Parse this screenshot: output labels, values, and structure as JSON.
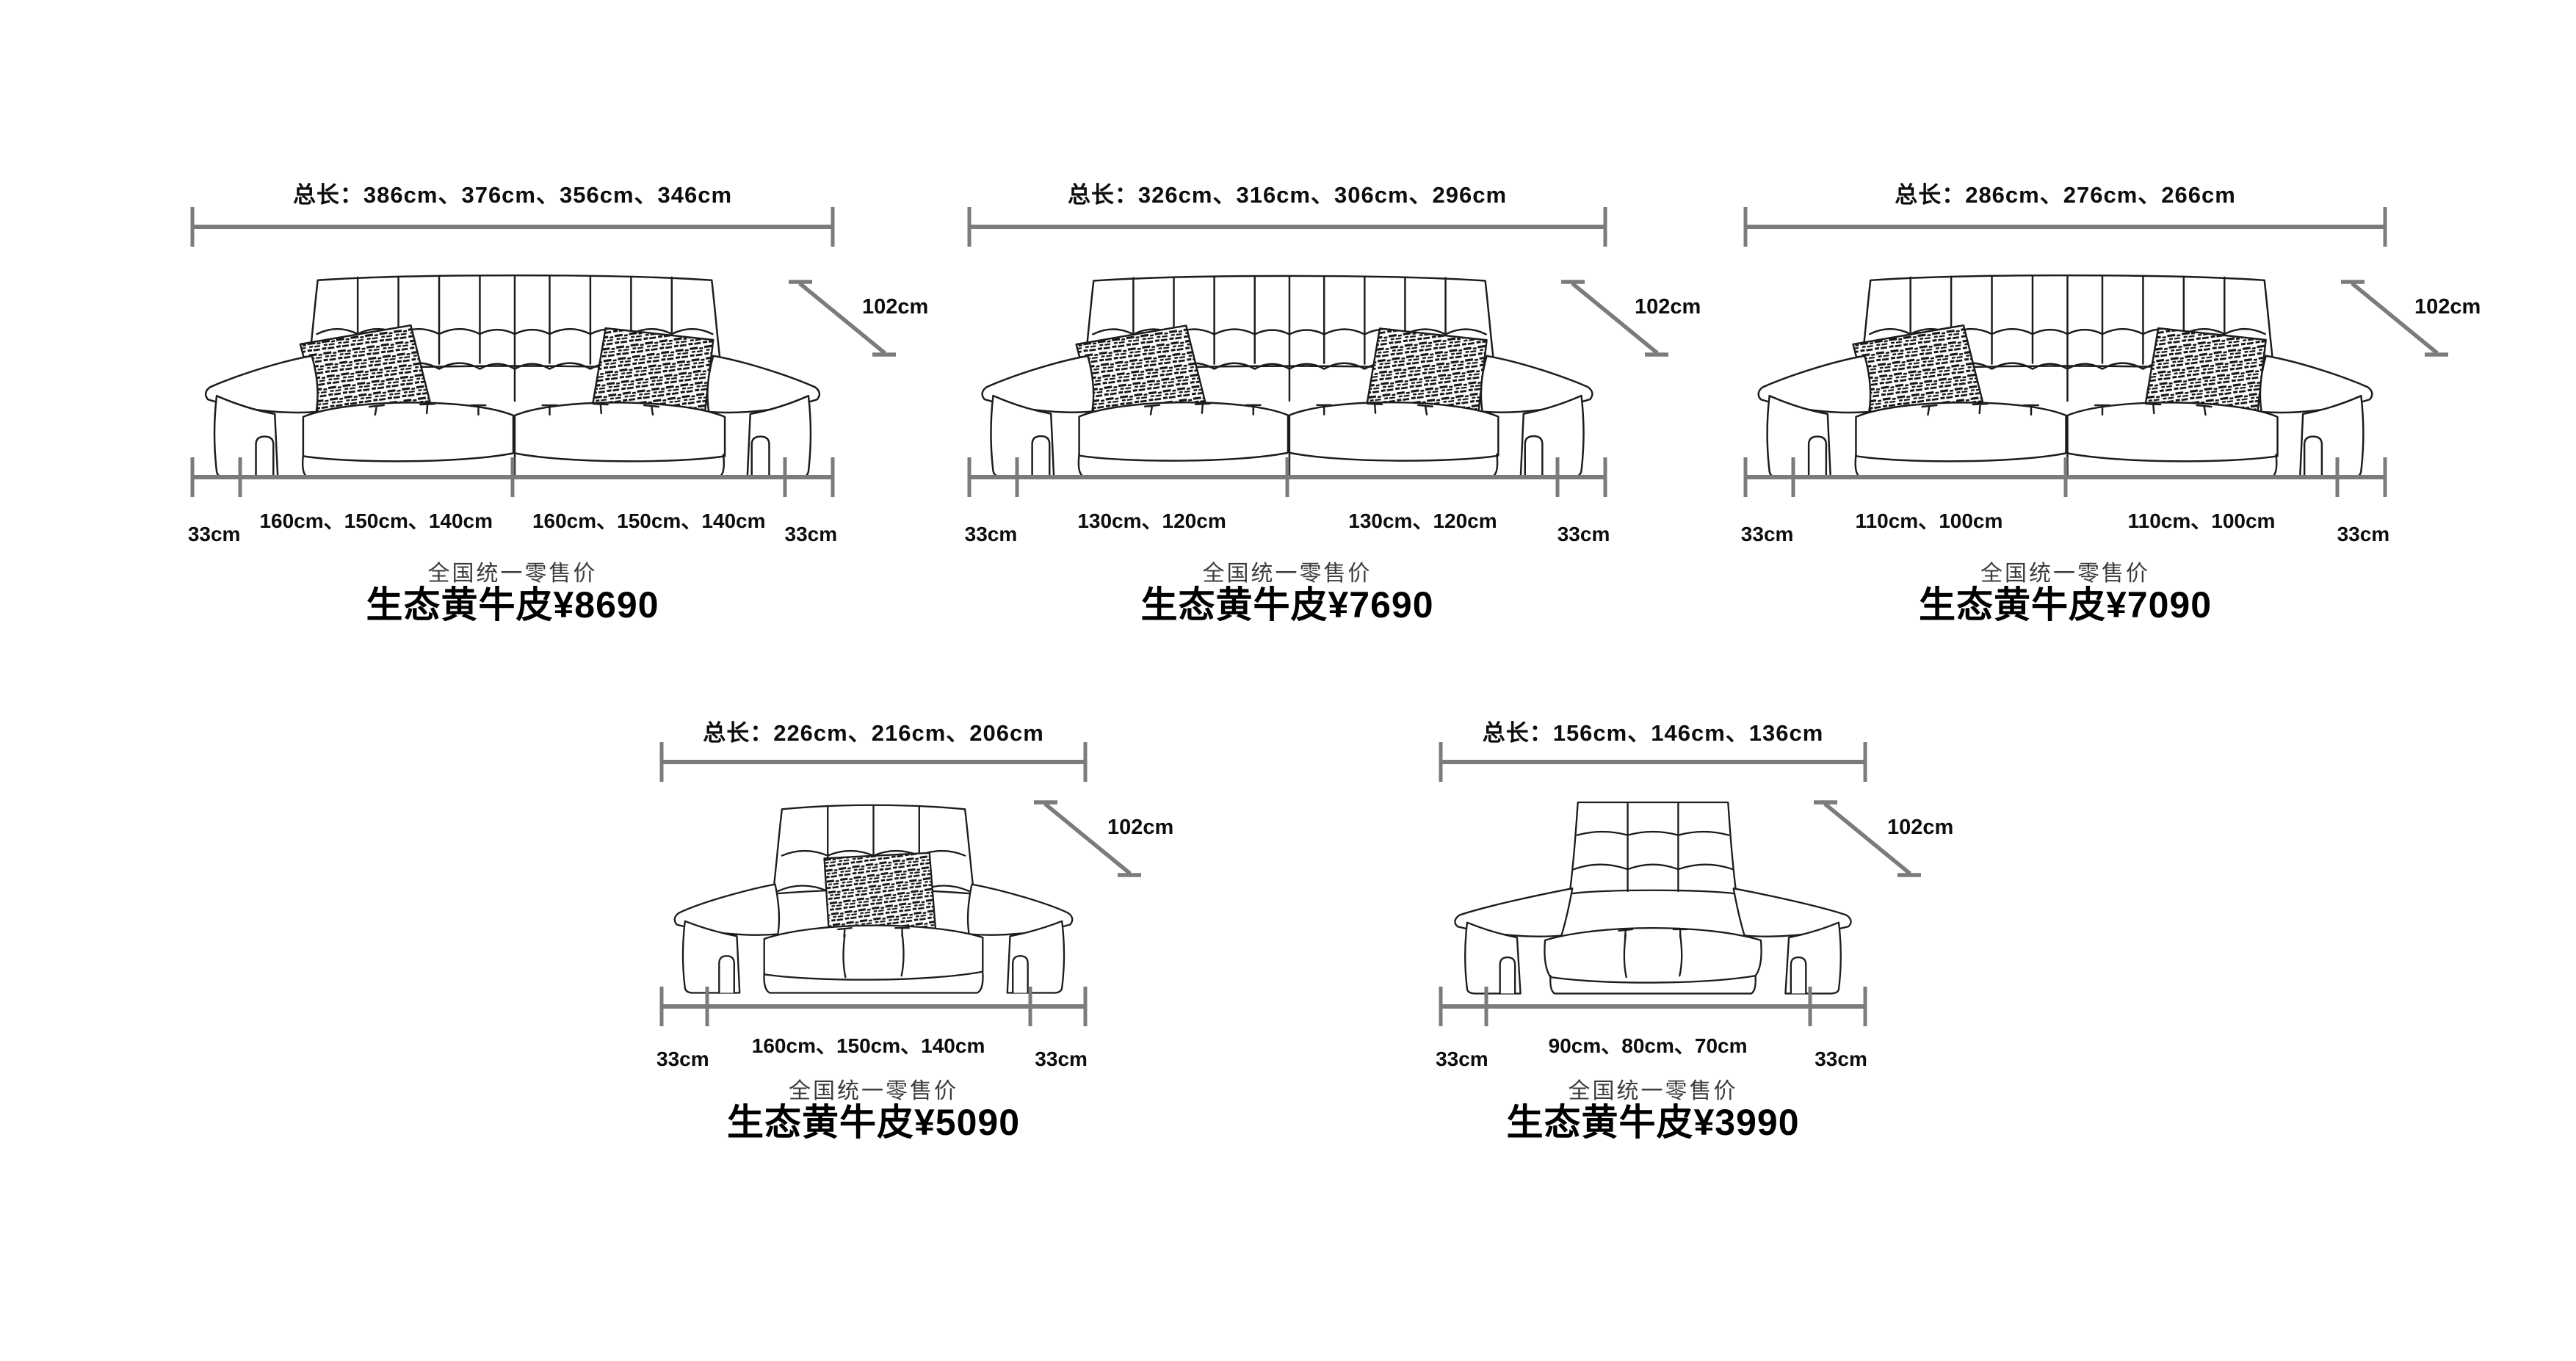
{
  "page": {
    "background": "#ffffff",
    "dimension_line_color": "#7b7b7b",
    "sketch_ink_color": "#1c1c1c",
    "text_color": "#0d0d0d",
    "retail_caption_color": "#3c3c3c"
  },
  "shared": {
    "side_label": "33cm",
    "depth_label": "102cm",
    "retail_label": "全国统一零售价"
  },
  "products": [
    {
      "total_length": "总长：386cm、376cm、356cm、346cm",
      "segments": [
        "160cm、150cm、140cm",
        "160cm、150cm、140cm"
      ],
      "price": "生态黄牛皮¥8690",
      "sofa_type": "three-seat-two-pillows"
    },
    {
      "total_length": "总长：326cm、316cm、306cm、296cm",
      "segments": [
        "130cm、120cm",
        "130cm、120cm"
      ],
      "price": "生态黄牛皮¥7690",
      "sofa_type": "three-seat-two-pillows"
    },
    {
      "total_length": "总长：286cm、276cm、266cm",
      "segments": [
        "110cm、100cm",
        "110cm、100cm"
      ],
      "price": "生态黄牛皮¥7090",
      "sofa_type": "three-seat-two-pillows"
    },
    {
      "total_length": "总长：226cm、216cm、206cm",
      "segments": [
        "160cm、150cm、140cm"
      ],
      "price": "生态黄牛皮¥5090",
      "sofa_type": "loveseat-one-pillow"
    },
    {
      "total_length": "总长：156cm、146cm、136cm",
      "segments": [
        "90cm、80cm、70cm"
      ],
      "price": "生态黄牛皮¥3990",
      "sofa_type": "armchair"
    }
  ]
}
